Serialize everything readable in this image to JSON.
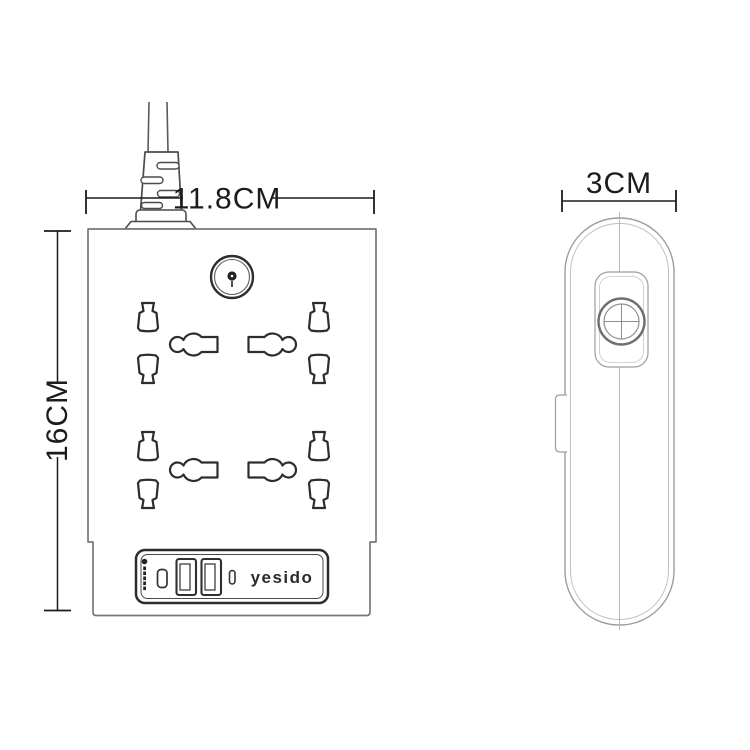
{
  "diagram": {
    "type": "product-dimension-drawing",
    "product": "power-strip-with-usb",
    "brand_logo": "yesido",
    "dimensions": {
      "width_label": "11.8CM",
      "height_label": "16CM",
      "depth_label": "3CM"
    },
    "front_view": {
      "socket_rows": 2,
      "sockets_per_row": 2,
      "usb_a_ports": 2,
      "usb_c_ports": 2,
      "power_button": 1
    },
    "colors": {
      "background": "#ffffff",
      "outline_dark": "#2f2f2f",
      "outline_medium": "#707070",
      "outline_light": "#a5a5a5",
      "dimension_ink": "#1c1c1c"
    }
  }
}
